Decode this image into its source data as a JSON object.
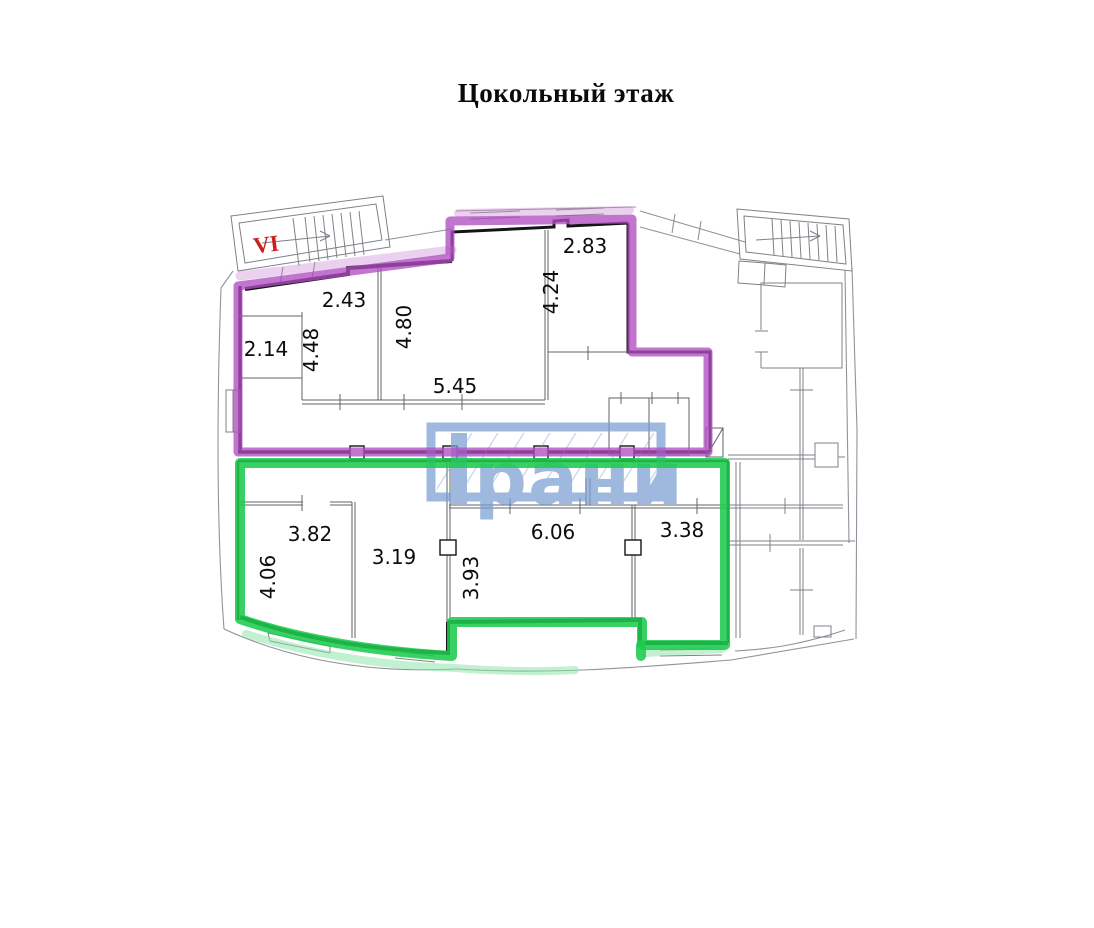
{
  "title": "Цокольный этаж",
  "watermark": {
    "text": "рани"
  },
  "plan": {
    "stairwell_label": "VI",
    "room_labels": [
      {
        "text": "2.83"
      },
      {
        "text": "4.24"
      },
      {
        "text": "2.43"
      },
      {
        "text": "4.80"
      },
      {
        "text": "4.48"
      },
      {
        "text": "2.14"
      },
      {
        "text": "5.45"
      },
      {
        "text": "3.82"
      },
      {
        "text": "4.06"
      },
      {
        "text": "3.19"
      },
      {
        "text": "3.93"
      },
      {
        "text": "6.06"
      },
      {
        "text": "3.38"
      }
    ]
  },
  "colors": {
    "purple": "#b04ec2",
    "purple_light": "#cf8ad8",
    "green": "#1ecb4f",
    "green_light": "#86e4a3",
    "watermark_blue": "#7b9ed2",
    "stair_label_red": "#cc1f1f"
  }
}
